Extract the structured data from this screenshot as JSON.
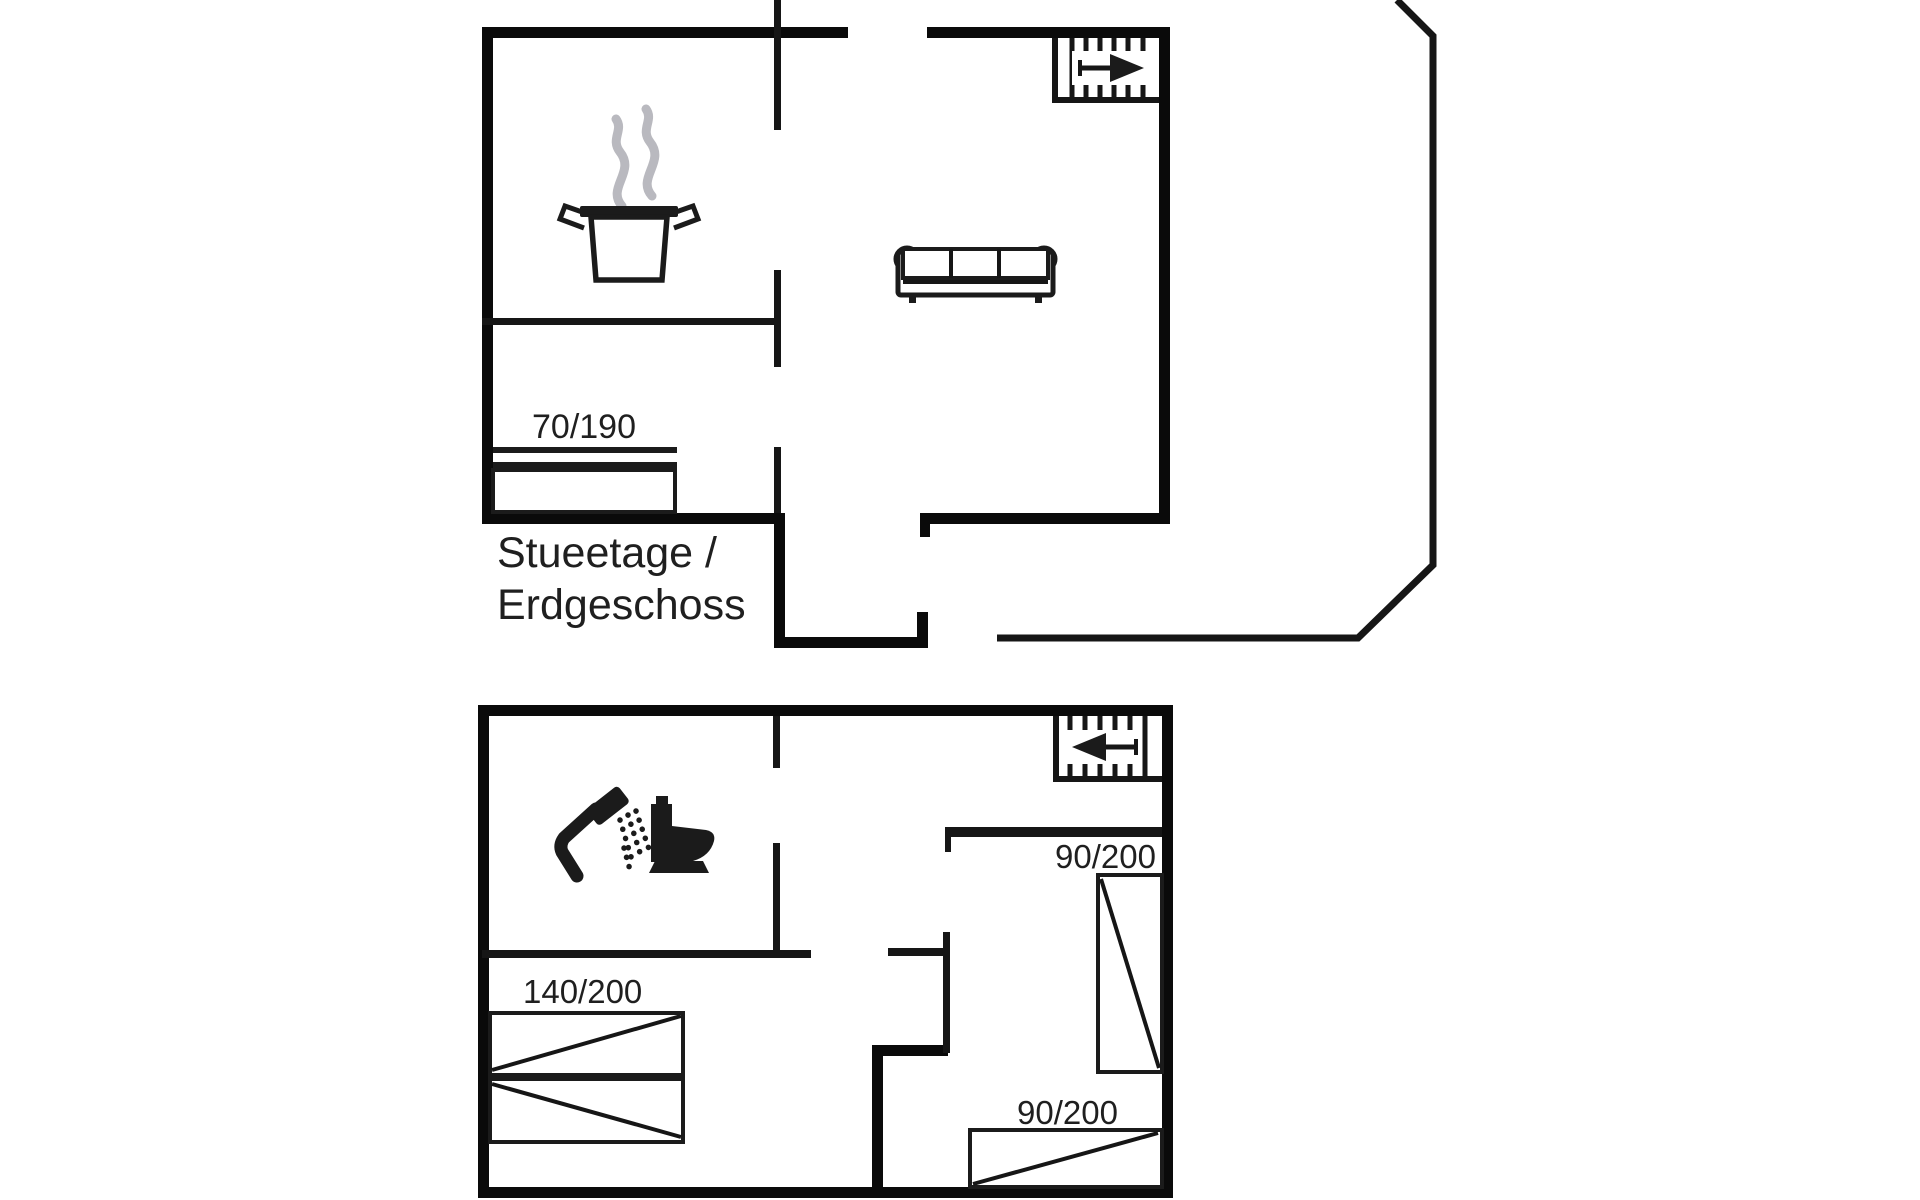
{
  "document": {
    "type": "floorplan",
    "background": "#ffffff"
  },
  "colors": {
    "wall": "#0a0a0a",
    "thin": "#161616",
    "furniture": "#1b1b1b",
    "steam": "#b9b9bf",
    "text": "#1f1f1f",
    "halo": "#ffffff"
  },
  "floors": [
    {
      "id": "ground-floor",
      "title_line1": "Stueetage /",
      "title_line2": "Erdgeschoss",
      "bed_labels": [
        "70/190"
      ],
      "icons": [
        "stairs-up-icon",
        "stair-arrow-right-icon",
        "steam-icon",
        "kitchen-pot-icon",
        "sofa-icon",
        "single-bed-icon"
      ]
    },
    {
      "id": "upper-floor",
      "bed_labels": [
        "140/200",
        "90/200",
        "90/200"
      ],
      "icons": [
        "stairs-down-icon",
        "stair-arrow-left-icon",
        "shower-icon",
        "toilet-icon",
        "double-bed-icon",
        "single-bed-icon",
        "single-bed-icon"
      ]
    }
  ]
}
